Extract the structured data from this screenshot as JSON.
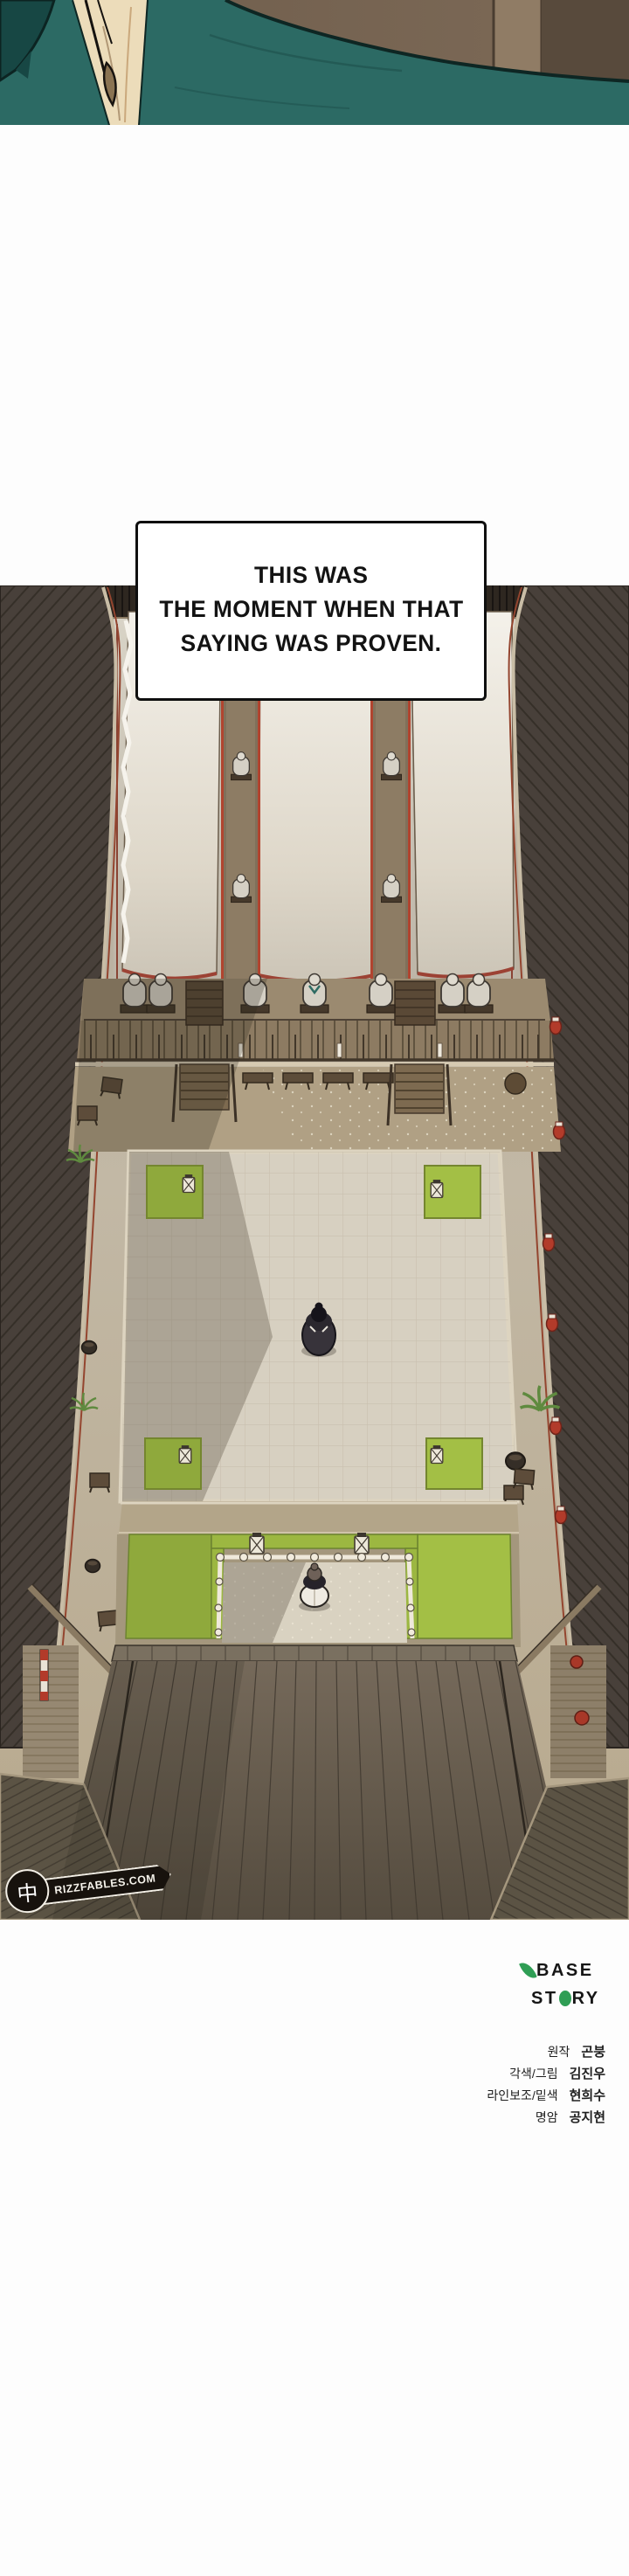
{
  "caption": {
    "lines": [
      "THIS WAS",
      "THE MOMENT WHEN THAT",
      "SAYING WAS PROVEN."
    ]
  },
  "watermark": {
    "cjk": "中",
    "site": "RIZZFABLES.COM"
  },
  "logo": {
    "base": "BASE",
    "st": "ST",
    "ry": "RY"
  },
  "credits": {
    "rows": [
      {
        "role": "원작",
        "name": "곤붕"
      },
      {
        "role": "각색/그림",
        "name": "김진우"
      },
      {
        "role": "라인보조/밑색",
        "name": "현희수"
      },
      {
        "role": "명암",
        "name": "공지현"
      }
    ]
  },
  "colors": {
    "robe_teal": "#2c6a64",
    "banner_white": "#f2efe7",
    "mat_green": "#a3bf45",
    "lantern_red": "#b23b2a",
    "roof_dark": "#48403a",
    "leaf_green": "#2f9e55",
    "page_bg": "#fdfdfd"
  }
}
